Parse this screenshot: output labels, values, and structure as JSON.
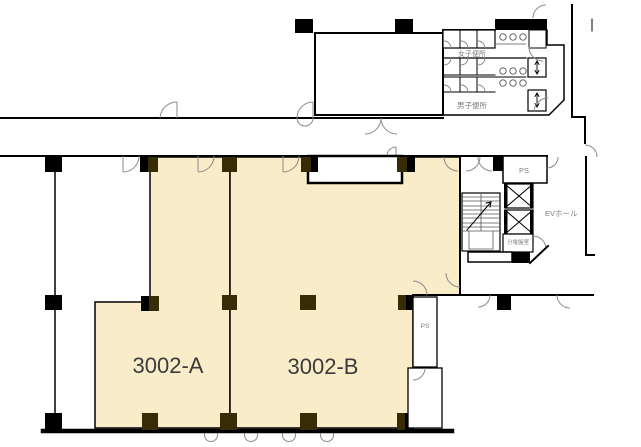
{
  "plan": {
    "title": "floor-plan-3002",
    "units": [
      {
        "id": "3002-A",
        "label": "3002-A"
      },
      {
        "id": "3002-B",
        "label": "3002-B"
      }
    ],
    "rooms": {
      "womens_toilet": "女子便所",
      "mens_toilet": "男子便所",
      "ev_hall": "EVホール",
      "distribution_board_room": "分電盤室",
      "pipe_space_upper": "PS",
      "pipe_space_lower": "PS"
    },
    "colors": {
      "unit_fill": "#f9ecc8",
      "column_dark": "#382c06",
      "column_black": "#000000",
      "wall": "#000000",
      "door_stroke": "#8a8a8a",
      "room_label": "#7d7d7d",
      "unit_label": "#3b3b3b"
    }
  }
}
